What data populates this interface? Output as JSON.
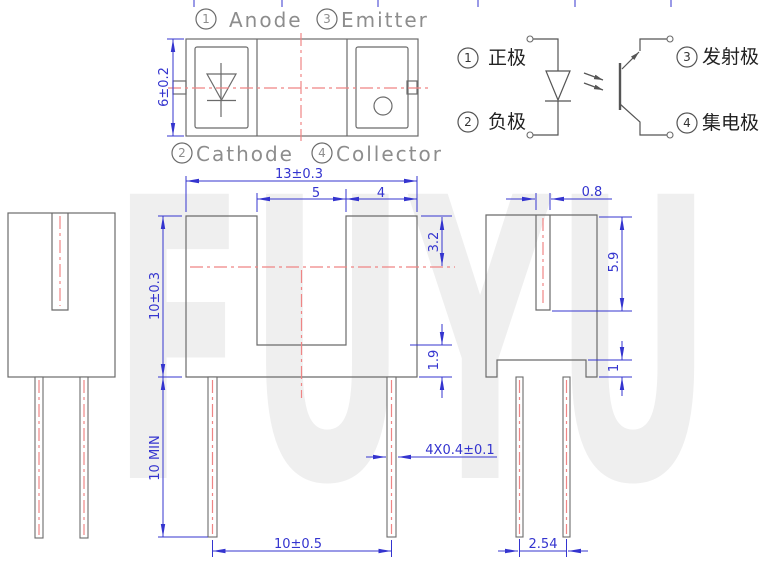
{
  "watermark": "FUYU",
  "colors": {
    "dimension_blue": "#3434cf",
    "outline_gray": "#6b6b6b",
    "centerline_red": "#ef8585",
    "label_gray": "#8d8d8d",
    "schematic_dark": "#555555",
    "watermark_gray": "#efefef"
  },
  "pin_labels": {
    "pin1": {
      "num": "1",
      "en": "Anode",
      "zh": "正极"
    },
    "pin2": {
      "num": "2",
      "en": "Cathode",
      "zh": "负极"
    },
    "pin3": {
      "num": "3",
      "en": "Emitter",
      "zh": "发射极"
    },
    "pin4": {
      "num": "4",
      "en": "Collector",
      "zh": "集电极"
    }
  },
  "dimensions": {
    "top_view_height": "6±0.2",
    "body_width": "13±0.3",
    "slot_width": "5",
    "right_segment": "4",
    "body_height": "10±0.3",
    "axis_from_top": "3.2",
    "slot_to_bottom": "1.9",
    "lead_length": "10 MIN",
    "outer_lead_span": "10±0.5",
    "lead_width": "4X0.4±0.1",
    "side_slot_width": "0.8",
    "side_slot_depth": "5.9",
    "standoff_height": "1",
    "lead_pitch": "2.54"
  }
}
